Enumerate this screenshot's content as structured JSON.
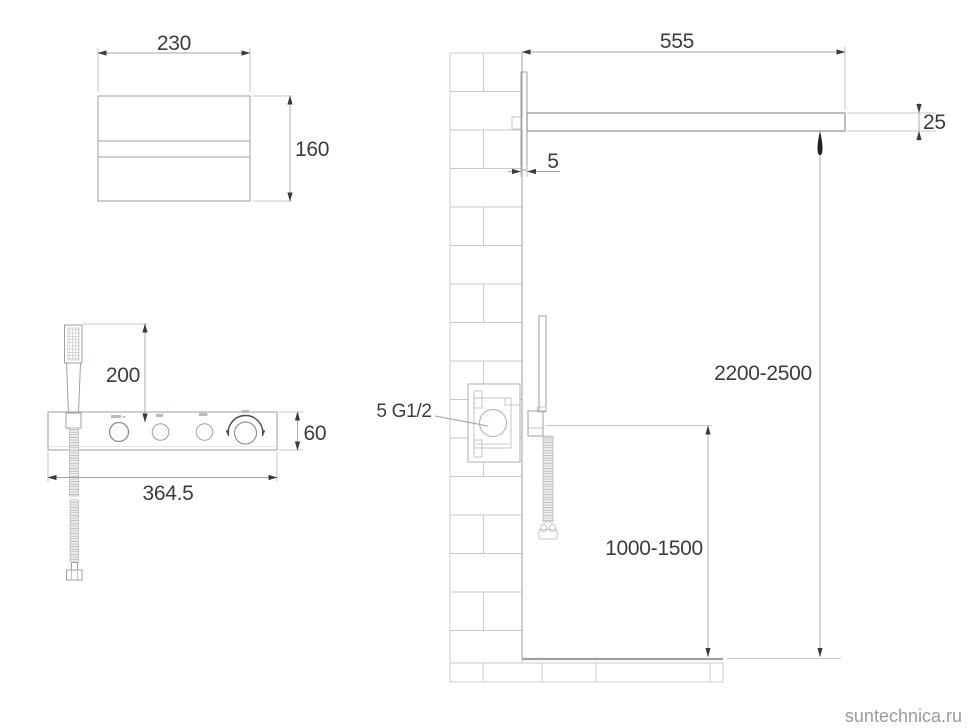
{
  "watermark": "suntechnica.ru",
  "front_plate_view": {
    "width_label": "230",
    "height_label": "160"
  },
  "front_panel_view": {
    "handshower_offset_label": "200",
    "panel_height_label": "60",
    "panel_width_label": "364.5"
  },
  "side_view": {
    "arm_length_label": "555",
    "arm_thickness_label": "25",
    "plate_thickness_label": "5",
    "connection_label": "5 G1/2",
    "head_height_range_label": "2200-2500",
    "handset_height_range_label": "1000-1500"
  },
  "icons": {
    "water_drop": "water-drop-arrow",
    "knob_icons": [
      "knob-icon-1",
      "knob-icon-2",
      "knob-icon-3",
      "knob-icon-4"
    ]
  },
  "colors": {
    "line_gray": "#9aa0a3",
    "light_line": "#c6c9cb",
    "dim_text": "#3c3c3c",
    "watermark_gray": "#9b9b9b"
  }
}
